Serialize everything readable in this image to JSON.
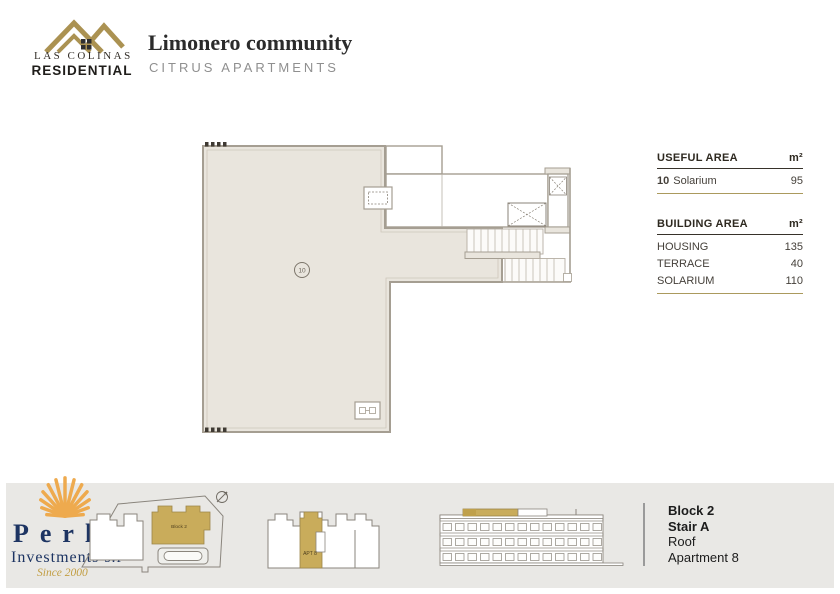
{
  "brand": {
    "name_top": "LAS COLINAS",
    "name_bottom": "RESIDENTIAL"
  },
  "header": {
    "title": "Limonero community",
    "subtitle": "CITRUS APARTMENTS"
  },
  "plan": {
    "room_label": "10"
  },
  "tables": {
    "useful": {
      "title": "USEFUL AREA",
      "unit": "m²",
      "rows": [
        {
          "num": "10",
          "label": "Solarium",
          "value": "95"
        }
      ]
    },
    "building": {
      "title": "BUILDING AREA",
      "unit": "m²",
      "rows": [
        {
          "label": "HOUSING",
          "value": "135"
        },
        {
          "label": "TERRACE",
          "value": "40"
        },
        {
          "label": "SOLARIUM",
          "value": "110"
        }
      ]
    }
  },
  "footer": {
    "logo": {
      "name": "Perla",
      "subtitle": "Investments s.l",
      "since": "Since 2000"
    },
    "site_plan": {
      "block_label": "Block 2"
    },
    "floor_strip": {
      "apt_label": "APT 8"
    },
    "location": {
      "line1": "Block 2",
      "line2": "Stair A",
      "line3": "Roof",
      "line4": "Apartment 8"
    }
  },
  "colors": {
    "logo_gold": "#ab9252",
    "navy": "#1d3462",
    "plan_fill": "#e9e5dd",
    "wall": "#a59e92",
    "accent_line": "#ab9a5d",
    "shell_orange": "#eeaa4e",
    "footer_band": "#e9e8e5",
    "block_gold": "#c9ac5b"
  }
}
